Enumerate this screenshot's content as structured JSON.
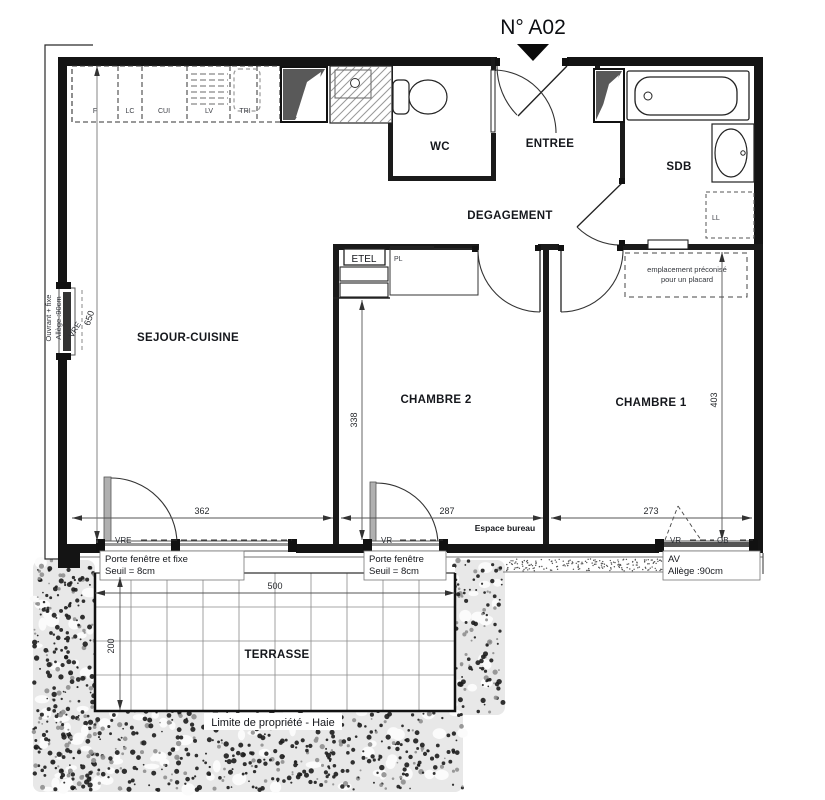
{
  "title": {
    "number": "N° A02"
  },
  "rooms": {
    "sejour": "SEJOUR-CUISINE",
    "wc": "WC",
    "entree": "ENTREE",
    "degagement": "DEGAGEMENT",
    "sdb": "SDB",
    "chambre2": "CHAMBRE 2",
    "chambre1": "CHAMBRE 1",
    "terrasse": "TERRASSE"
  },
  "kitchen": {
    "units": [
      "F",
      "LC",
      "CUI",
      "LV",
      "TRI"
    ]
  },
  "closets": {
    "etel": "ETEL",
    "pl": "PL",
    "ll": "LL",
    "placard_note_line1": "emplacement préconisé",
    "placard_note_line2": "pour un placard"
  },
  "openings": {
    "left_window": {
      "label_line1": "Ouvrant + fixe",
      "label_line2": "Allège :90cm",
      "tag": "VRE"
    },
    "window1": {
      "label_line1": "Porte fenêtre et fixe",
      "label_line2": "Seuil = 8cm",
      "tag": "VRE"
    },
    "window2": {
      "label_line1": "Porte fenêtre",
      "label_line2": "Seuil = 8cm",
      "tag": "VR"
    },
    "window3": {
      "label_line1": "AV",
      "label_line2": "Allège :90cm",
      "tag_vr": "VR",
      "tag_ob": "OB"
    }
  },
  "dimensions": {
    "sejour_width": "362",
    "chambre2_width": "287",
    "chambre1_width": "273",
    "chambre2_depth": "338",
    "chambre1_depth": "403",
    "sejour_depth": "650",
    "terrasse_width": "500",
    "terrasse_depth": "200"
  },
  "annotations": {
    "espace_bureau": "Espace bureau",
    "limite": "Limite de propriété - Haie"
  }
}
